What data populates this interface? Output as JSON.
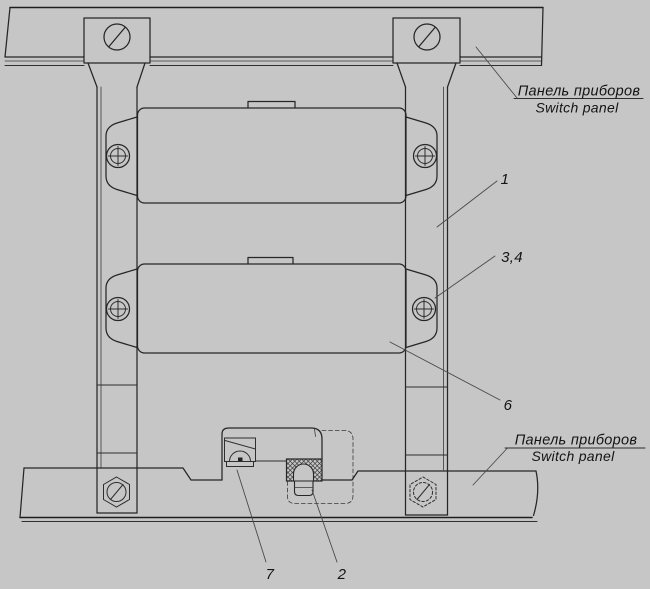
{
  "colors": {
    "background": "#c6c6c6",
    "line": "#262626",
    "leader": "#4a4a4a",
    "text": "#141414"
  },
  "labels": {
    "panel_top": {
      "ru": "Панель приборов",
      "en": "Switch panel"
    },
    "panel_bottom": {
      "ru": "Панель приборов",
      "en": "Switch panel"
    },
    "callout_1": "1",
    "callout_3_4": "3,4",
    "callout_6": "6",
    "callout_7": "7",
    "callout_2": "2"
  }
}
